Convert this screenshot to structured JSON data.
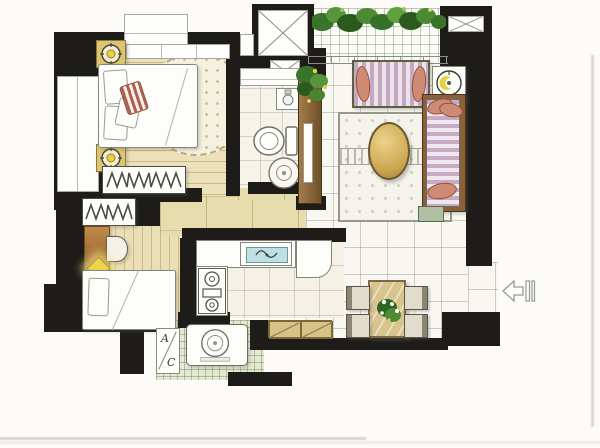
{
  "title": "hand-drawn watercolor apartment floor plan",
  "labels": {
    "ac_top": "A",
    "ac_bottom": "C"
  },
  "palette": {
    "wall_black": "#1d1c19",
    "wood_floor": "#ece1bb",
    "hall_floor": "#e7dcae",
    "tile_floor": "#f8f7f2",
    "balcony_tile": "#fbfbf6",
    "utility_tile": "#e4ead2",
    "sofa_stripe_mauve": "#c5a8c2",
    "pillow_salmon": "#cf8a74",
    "accent_stripe_red": "#b06050",
    "coffee_table_gold": "#cba64f",
    "cabinet_brown": "#8a6038",
    "plant_green": "#3a742b",
    "lamp_yellow": "#e8d044",
    "sink_water_blue": "#bfe0e2"
  },
  "rooms": [
    "bedroom-1",
    "bedroom-2",
    "bathroom",
    "hallway",
    "kitchen",
    "living-room",
    "dining-area",
    "balcony-garden",
    "utility-balcony",
    "entry"
  ],
  "furniture_icons": [
    "double-bed",
    "round-dotted-rug",
    "nightstand-lamps",
    "wardrobe-with-hanger-marks-1",
    "wardrobe-with-hanger-marks-2",
    "desk",
    "half-round-chair",
    "single-bed",
    "bathroom-shelf",
    "wash-basin",
    "toilet",
    "floor-drain",
    "tv-cabinet-with-plant",
    "three-seat-sofa",
    "side-table-lamp",
    "daybed-chaise",
    "plant-side-table",
    "area-rug",
    "oval-coffee-table",
    "kitchen-counter-sink",
    "stove",
    "refrigerator",
    "dining-table-with-flowers",
    "four-dining-chairs",
    "sideboard-cabinet",
    "washing-machine",
    "ac-unit-box",
    "entry-direction-arrow",
    "balcony-plant-row",
    "duct-shaft-x-boxes"
  ]
}
